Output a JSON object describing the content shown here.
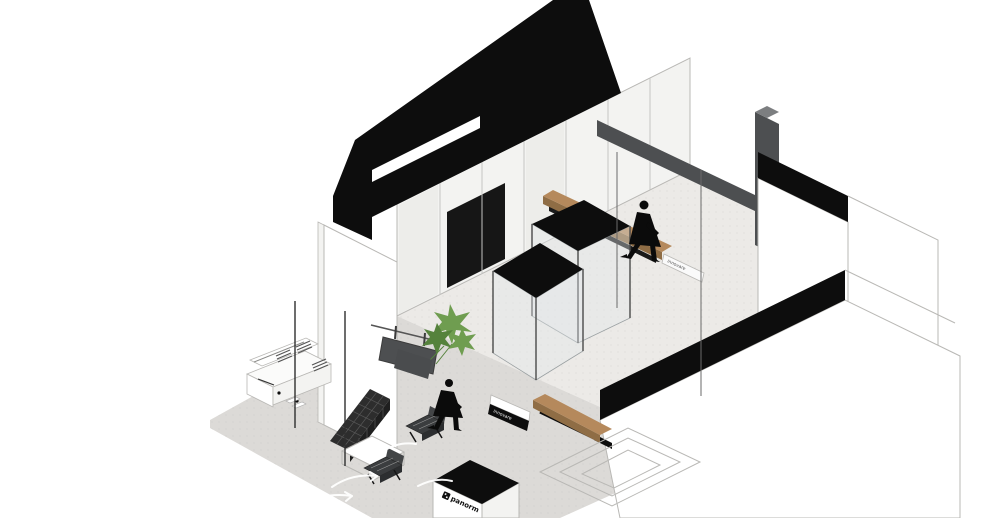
{
  "scene": {
    "style": "black-and-white axonometric interior rendering",
    "room": "retail showroom with street-front lounge",
    "objects": [
      "black-roof-slab-with-skylight",
      "wardrobe-wall",
      "dark-steel-beam-and-column",
      "right-wall-black-band-upper",
      "front-wall-black-band",
      "left-pier",
      "glass-vitrine-back",
      "glass-vitrine-front",
      "wood-bench-back",
      "wood-bench-entry",
      "hanging-dark-panel",
      "potted-plant",
      "walking-figure-back",
      "walking-figure-front",
      "reception-desk",
      "tufted-bench",
      "lounge-chair-1",
      "lounge-chair-2",
      "coffee-table",
      "entry-counter-with-logo",
      "ghost-outline-steps",
      "floor-arrow-markings",
      "storefront-posts"
    ]
  },
  "signs": {
    "counter_logo": "panorm",
    "entry_sign": "innovare",
    "bench_plaque": "innovare"
  },
  "colors": {
    "black": "#0d0d0d",
    "white": "#ffffff",
    "wall_tint": "#f3f3f1",
    "outline": "#b9b8b5",
    "line_dark": "#3a3a3a",
    "floor_interior": "#eceae7",
    "floor_sidewalk": "#dcdad7",
    "dark_gray": "#4d4f51",
    "mid_gray": "#7c7e80",
    "glass": "#e3e8e9",
    "glass_line": "#9aa0a2",
    "wood": "#b5895c",
    "wood_shadow": "#8f6d45",
    "plant": "#6f9d50",
    "plant_dark": "#55823c",
    "bench_dark": "#2d2d2d",
    "bench_front": "#1f1f1f",
    "chair": "#3b3d3f",
    "chair_front": "#2c2e30",
    "tuft_line": "#575757",
    "logo_ink": "#111111"
  }
}
